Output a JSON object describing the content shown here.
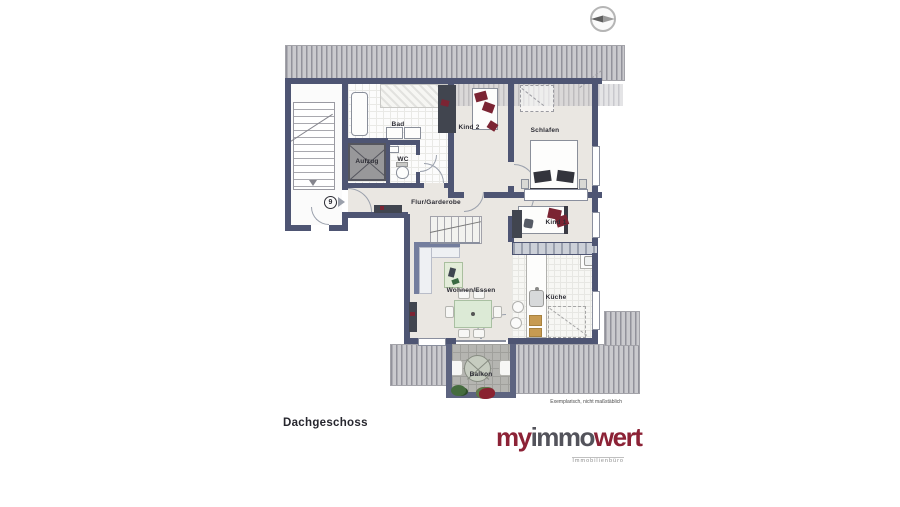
{
  "page": {
    "title": "Dachgeschoss"
  },
  "entrance": {
    "number": "9"
  },
  "rooms": [
    {
      "id": "bad",
      "label": "Bad"
    },
    {
      "id": "kind2",
      "label": "Kind 2"
    },
    {
      "id": "schlafen",
      "label": "Schlafen"
    },
    {
      "id": "wc",
      "label": "WC"
    },
    {
      "id": "aufzug",
      "label": "Aufzug"
    },
    {
      "id": "flur",
      "label": "Flur/Garderobe"
    },
    {
      "id": "kind1",
      "label": "Kind 1"
    },
    {
      "id": "wohnen",
      "label": "Wohnen/Essen"
    },
    {
      "id": "kueche",
      "label": "Küche"
    },
    {
      "id": "balkon",
      "label": "Balkon"
    }
  ],
  "disclaimer": "Exemplarisch, nicht maßstäblich",
  "logo": {
    "my": "my",
    "immo": "immo",
    "wert": "wert",
    "tagline": "Immobilienbüro"
  },
  "colors": {
    "wall": "#4e5573",
    "floor": "#eae7e2",
    "roof_hatch_dark": "#92929b",
    "roof_hatch_light": "#cacace",
    "furniture_maroon": "#7b2433",
    "logo_red": "#8c2236",
    "balcony_paver": "#b5b5b1"
  }
}
